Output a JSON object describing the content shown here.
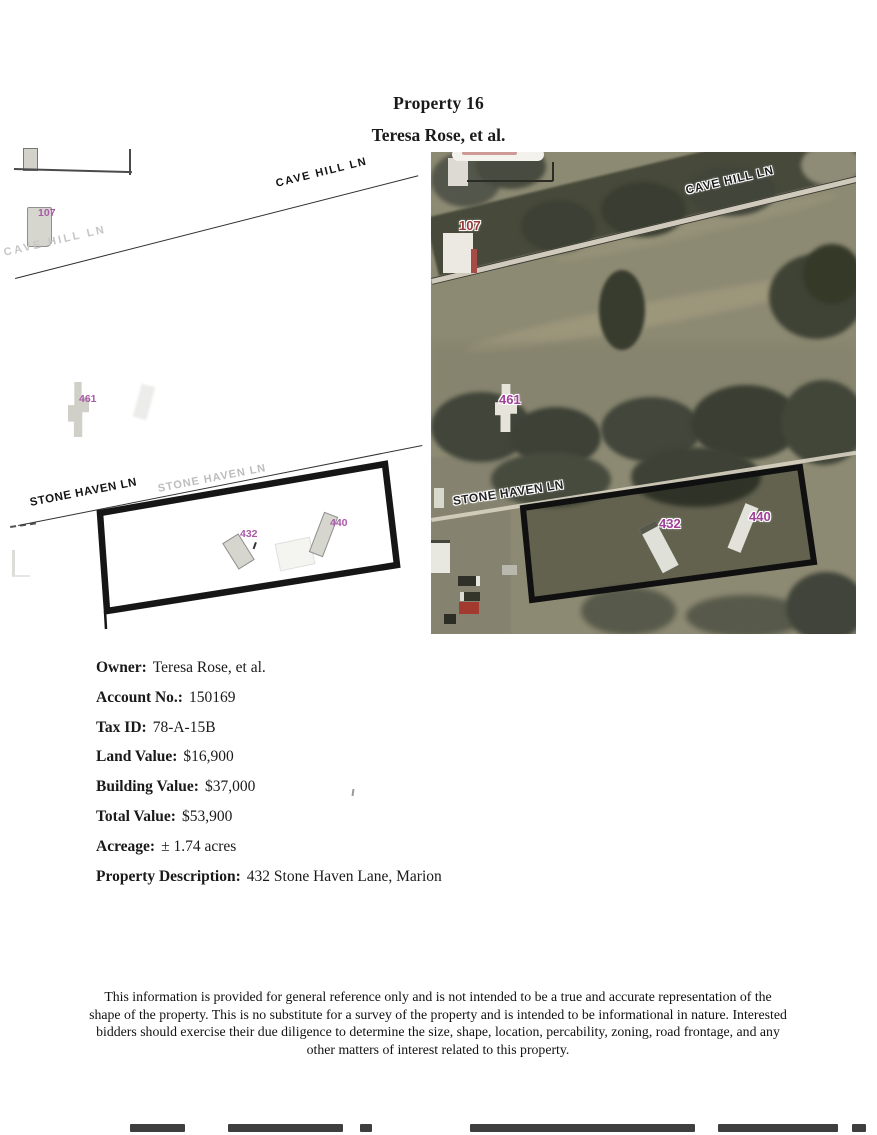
{
  "page": {
    "title": "Property 16",
    "subtitle": "Teresa Rose, et al."
  },
  "details": {
    "rows": [
      {
        "label": "Owner:",
        "value": "Teresa Rose, et al."
      },
      {
        "label": "Account No.:",
        "value": "150169"
      },
      {
        "label": "Tax ID:",
        "value": "78-A-15B"
      },
      {
        "label": "Land Value:",
        "value": "$16,900"
      },
      {
        "label": "Building Value:",
        "value": "$37,000"
      },
      {
        "label": "Total Value:",
        "value": "$53,900"
      },
      {
        "label": "Acreage:",
        "value": "± 1.74 acres"
      },
      {
        "label": "Property Description:",
        "value": "432 Stone Haven Lane, Marion"
      }
    ]
  },
  "disclaimer": "This information is provided for general reference only and is not intended to be a true and accurate representation of the shape of the property. This is no substitute for a survey of the property and is intended to be informational in nature. Interested bidders should exercise their due diligence to determine the size, shape, location, percability, zoning, road frontage, and any other matters of interest related to this property.",
  "parcel_map": {
    "cave_hill": "CAVE HILL LN",
    "cave_hill_faint": "CAVE HILL LN",
    "stone_haven": "STONE HAVEN LN",
    "stone_haven_faint": "STONE HAVEN LN",
    "p107": "107",
    "p461": "461",
    "p432": "432",
    "p440": "440"
  },
  "aerial_map": {
    "cave_hill": "CAVE HILL LN",
    "stone_haven": "STONE HAVEN LN",
    "p107": "107",
    "p461": "461",
    "p432": "432",
    "p440": "440"
  },
  "colors": {
    "parcel_label_purple": "#a85aa8",
    "aerial_label_magenta": "#a1409b",
    "aerial_label_red": "#993a38",
    "boundary_black": "#161616"
  }
}
